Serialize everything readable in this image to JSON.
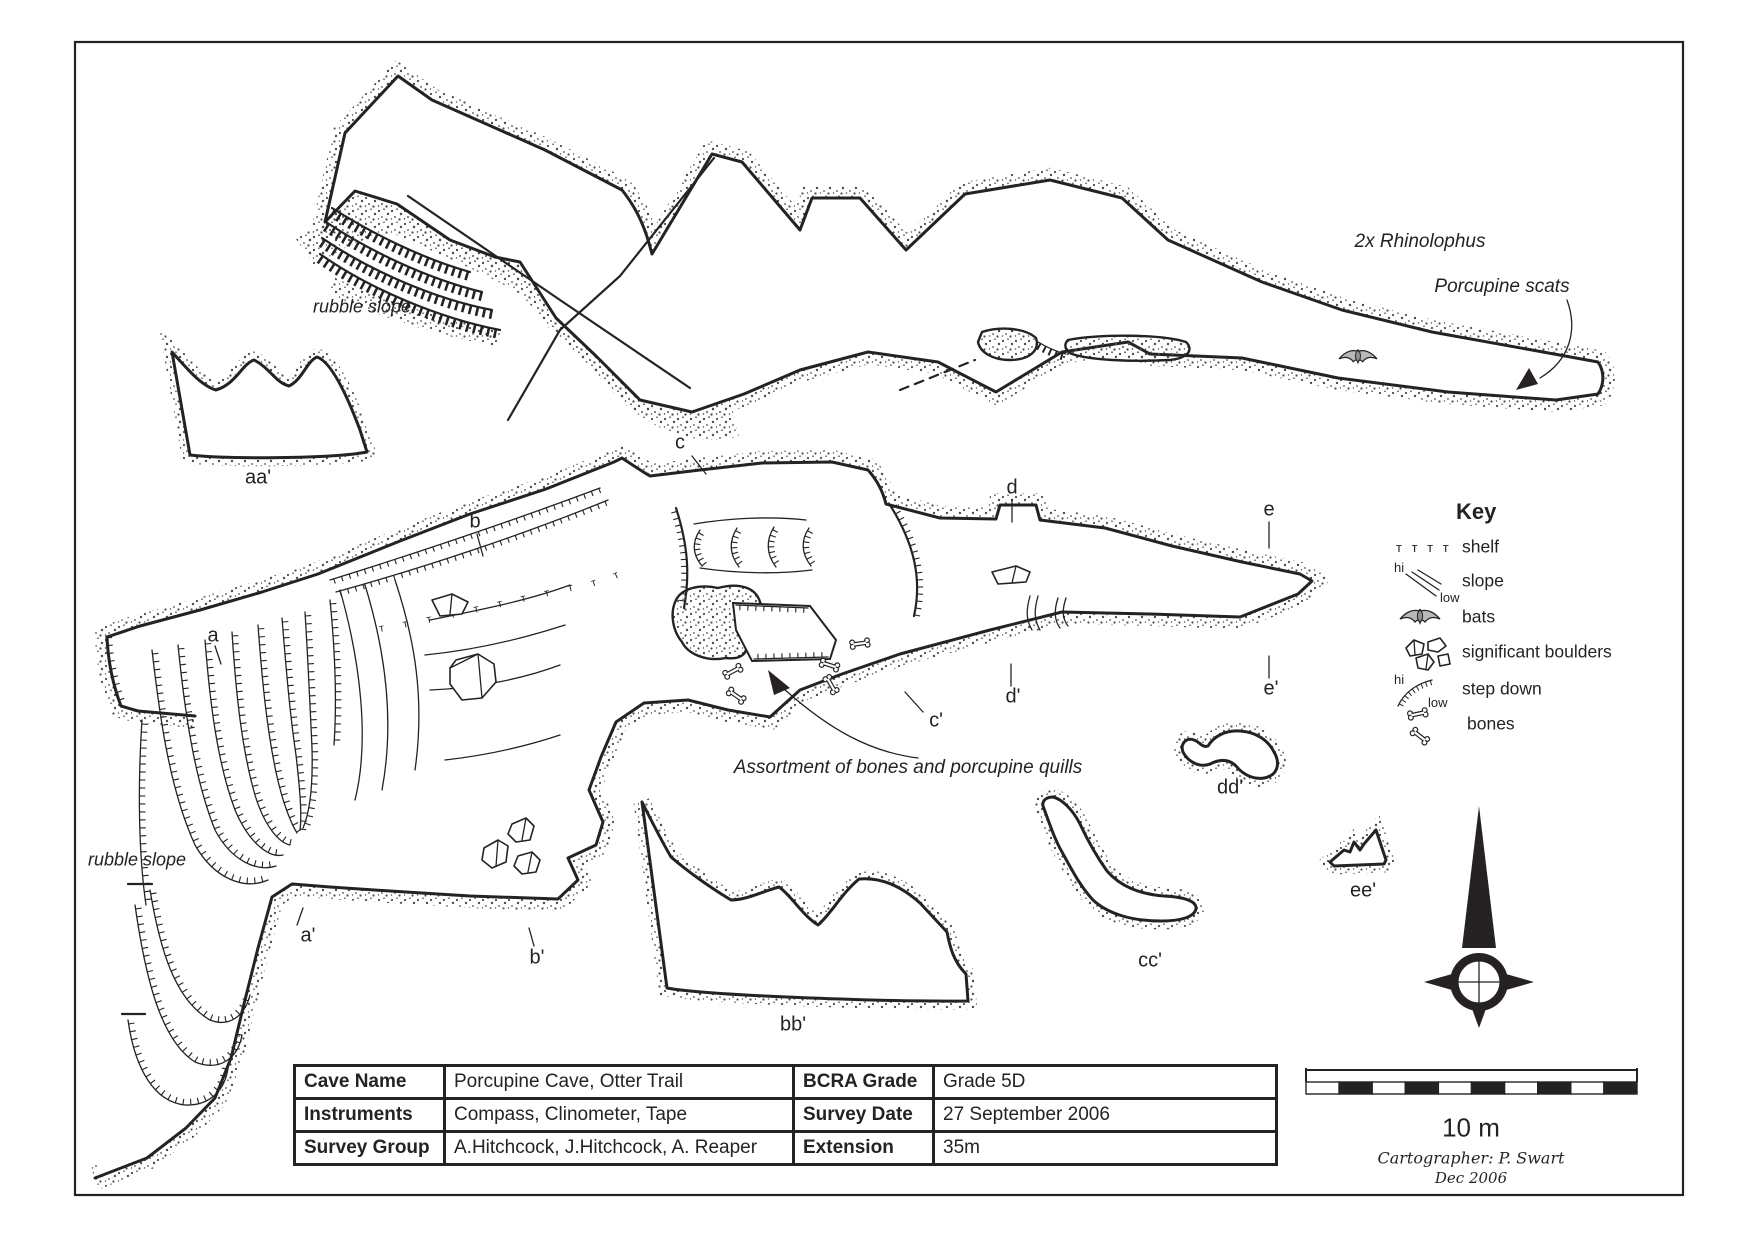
{
  "colors": {
    "ink": "#262223",
    "stipple": "#4f4b4c",
    "bat_fill": "#b9b9b9"
  },
  "sections": {
    "a": "a",
    "a_p": "a'",
    "b": "b",
    "b_p": "b'",
    "c": "c",
    "c_p": "c'",
    "d": "d",
    "d_p": "d'",
    "e": "e",
    "e_p": "e'",
    "aa": "aa'",
    "bb": "bb'",
    "cc": "cc'",
    "dd": "dd'",
    "ee": "ee'"
  },
  "annotations": {
    "rubble_slope_upper": "rubble slope",
    "rubble_slope_lower": "rubble slope",
    "bats_note": "2x Rhinolophus",
    "scats_note": "Porcupine scats",
    "bones_note": "Assortment of bones and porcupine quills"
  },
  "key": {
    "title": "Key",
    "shelf_symbol": "ᴛ ᴛ ᴛ ᴛ",
    "hi": "hi",
    "low": "low",
    "items": [
      {
        "icon": "shelf-icon",
        "label": "shelf"
      },
      {
        "icon": "slope-icon",
        "label": "slope"
      },
      {
        "icon": "bat-icon",
        "label": "bats"
      },
      {
        "icon": "boulders-icon",
        "label": "significant boulders"
      },
      {
        "icon": "step-down-icon",
        "label": "step down"
      },
      {
        "icon": "bones-icon",
        "label": "bones"
      }
    ]
  },
  "info_table": {
    "rows": [
      {
        "label_left": "Cave Name",
        "value_left": "Porcupine Cave, Otter Trail",
        "label_right": "BCRA Grade",
        "value_right": "Grade 5D"
      },
      {
        "label_left": "Instruments",
        "value_left": "Compass, Clinometer, Tape",
        "label_right": "Survey Date",
        "value_right": "27 September 2006"
      },
      {
        "label_left": "Survey Group",
        "value_left": "A.Hitchcock, J.Hitchcock, A. Reaper",
        "label_right": "Extension",
        "value_right": "35m"
      }
    ]
  },
  "scale_bar": {
    "label": "10 m",
    "cartographer": "Cartographer: P. Swart",
    "date": "Dec 2006"
  },
  "map_texture": {
    "shelf_row": "ᴛ ᴛ ᴛ ᴛ ᴛ ᴛ ᴛ ᴛ ᴛ ᴛ ᴛ ᴛ ᴛ"
  }
}
